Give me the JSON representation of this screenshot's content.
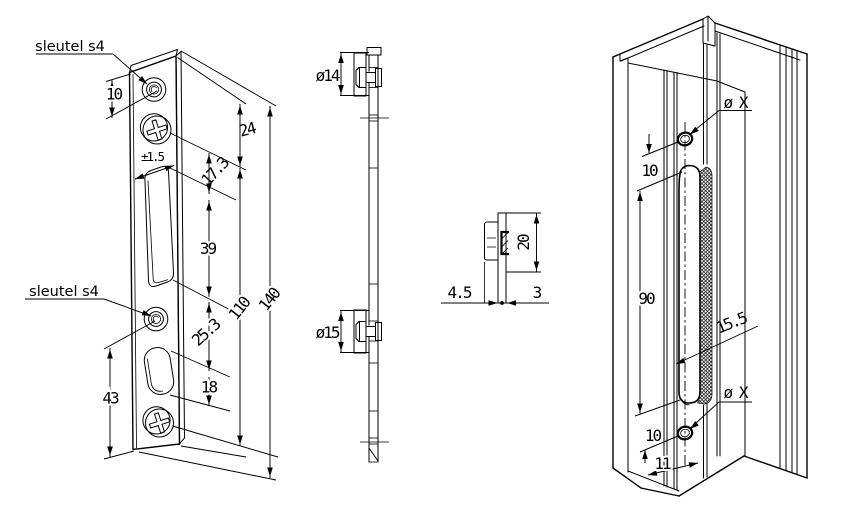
{
  "canvas": {
    "width": 848,
    "height": 512,
    "background": "#ffffff",
    "line_color": "#000000"
  },
  "front_view": {
    "label_top": "sleutel s4",
    "label_bottom": "sleutel s4",
    "dim_edge_to_hole": "10",
    "dim_top_to_screw": "24",
    "dim_tolerance": "±1.5",
    "dim_screw_to_slot": "17.3",
    "dim_slot_length": "39",
    "dim_screw_span": "110",
    "dim_total_length": "140",
    "dim_slot_to_oval": "25.3",
    "dim_oval_length": "18",
    "dim_hole_to_bottom": "43"
  },
  "section_view": {
    "dim_boss_top": "ø14",
    "dim_boss_bottom": "ø15"
  },
  "detail_view": {
    "dim_clip_height": "20",
    "dim_flange_width": "4.5",
    "dim_plate_thickness": "3"
  },
  "profile_view": {
    "dim_hole_top": "ø X",
    "dim_top_hole_offset": "10",
    "dim_slot_length": "90",
    "dim_slot_inset": "15.5",
    "dim_bottom_hole_offset": "10",
    "dim_hole_bottom": "ø X",
    "dim_edge_offset": "11"
  }
}
